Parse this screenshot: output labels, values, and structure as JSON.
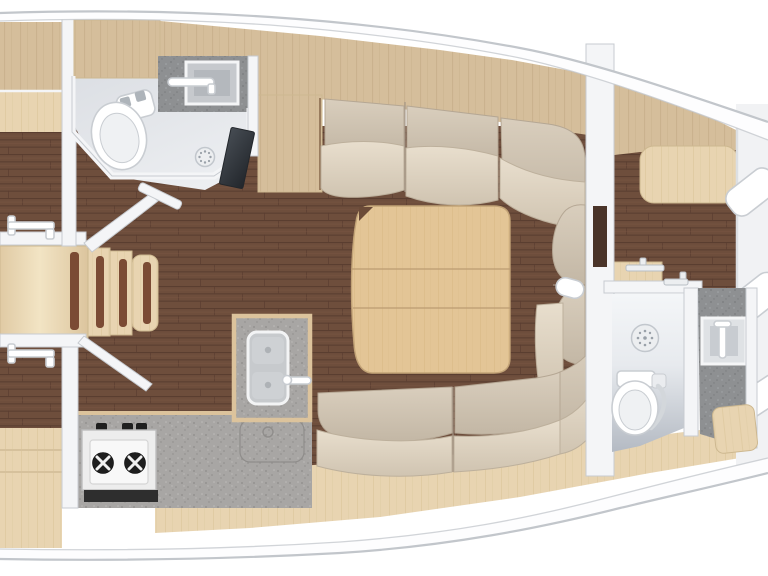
{
  "meta": {
    "label": "Sailing yacht interior floor plan, top-down view, bow to the right",
    "view": "plan",
    "orientation": "bow-right"
  },
  "palette": {
    "white": "#ffffff",
    "hullLine": "#c2c6cb",
    "wall": "#f4f5f7",
    "wallEdge": "#c7cbd0",
    "walnut": "#6e4e3c",
    "walnutDark": "#5a3e30",
    "walnutLight": "#7d5a47",
    "oakBand": "#d5be9b",
    "oakBandStripe": "#c8b18c",
    "oakLight": "#e8d4b1",
    "oakLightStripe": "#ddc89f",
    "oakTable": "#e3c596",
    "oakTableStripe": "#d8b985",
    "counter": "#a8a6a4",
    "counterDark": "#8e9092",
    "cushionBack": "#cfc3b1",
    "cushionSeat": "#ddd1bf",
    "fixture": "#ffffff",
    "fixtureEdge": "#c9cdd2",
    "doorDark": "#4a3429",
    "darkPanel": "#33383d",
    "bedding": "#f1f2f4"
  },
  "rooms": [
    {
      "id": "aft-cabin-port",
      "label": "aft cabin (port, cut at edge)"
    },
    {
      "id": "aft-head",
      "label": "aft head / wet room"
    },
    {
      "id": "companionway",
      "label": "companionway steps"
    },
    {
      "id": "aft-cabin-starboard",
      "label": "aft cabin (starboard, cut at edge)"
    },
    {
      "id": "galley",
      "label": "L-shaped galley"
    },
    {
      "id": "saloon",
      "label": "saloon with U-settee and folding table"
    },
    {
      "id": "forward-cabin",
      "label": "forward cabin"
    },
    {
      "id": "forward-head",
      "label": "forward head with shower"
    },
    {
      "id": "v-berth",
      "label": "V-berth with pillows"
    }
  ],
  "fixtures": [
    "toilet",
    "washbasin",
    "shower-drain",
    "two-burner-stove",
    "stove-knob",
    "double-sink",
    "sink-faucet",
    "folding-saloon-table",
    "table-fold-seam",
    "companionway-step",
    "non-slip-strip",
    "grab-rail",
    "door-latch",
    "settee-backrest-cushion",
    "settee-seat-cushion",
    "chaise-cushion",
    "towel-rail",
    "wood-seat",
    "pillow",
    "cabin-door-panel",
    "deck-fitting-pod"
  ]
}
